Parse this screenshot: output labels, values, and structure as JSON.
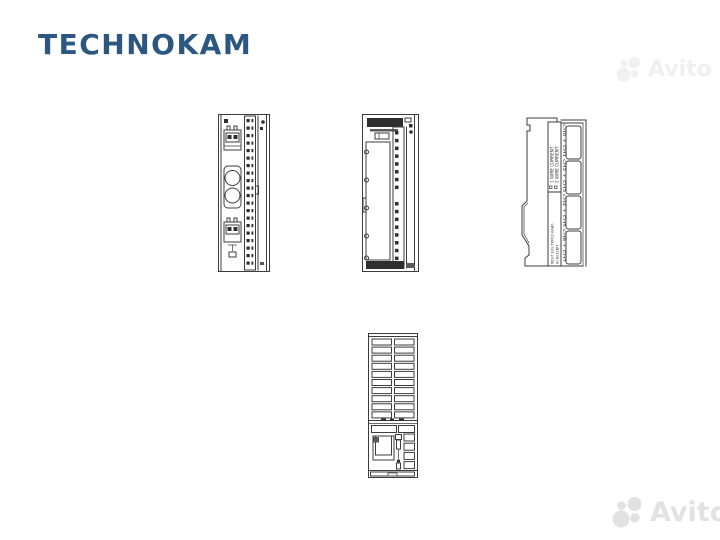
{
  "page": {
    "background_color": "#ffffff"
  },
  "brand": {
    "name": "TECHNOKAM",
    "color": "#2b5781"
  },
  "watermark_top": {
    "label": "Avito",
    "color": "#f0f0f0"
  },
  "watermark_bottom": {
    "label": "Avito",
    "color": "#e2e2e2"
  },
  "diagrams": {
    "stroke_color": "#3c3c3c",
    "side_view": {
      "wire_label_1": "1 WIRE CURRENT",
      "wire_label_2": "2 WIRE CURRENT",
      "part_label_1": "6ES7 331-7KF02-0AB0",
      "part_label_2": "AI 8x12BIT",
      "channel_labels": "CH0 + CH1   CH2 + CH3   CH4 + CH5   CH6 + CH7"
    }
  }
}
